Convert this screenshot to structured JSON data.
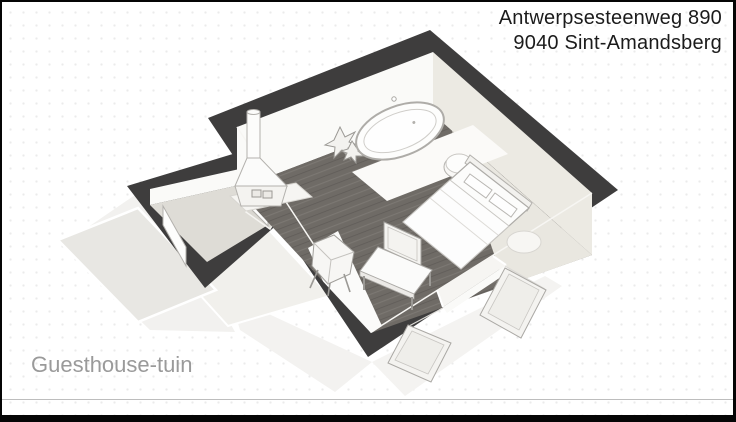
{
  "header": {
    "address_line1": "Antwerpsesteenweg 890",
    "address_line2": "9040 Sint-Amandsberg"
  },
  "caption": {
    "area_label": "Guesthouse-tuin"
  },
  "floorplan": {
    "view": "3d-isometric-floor-plan",
    "rooms": [
      {
        "name": "guesthouse-main-room",
        "floor_materials": [
          "dark-wood-plank",
          "light-carpet"
        ]
      },
      {
        "name": "entry-vestibule",
        "floor_materials": [
          "light-stone"
        ]
      }
    ],
    "furniture": [
      "wood-burning-stove",
      "floor-plant",
      "freestanding-oval-bathtub",
      "bath-mat",
      "round-pouf",
      "double-bed-with-pillows",
      "bedside-round-rug",
      "tv-on-low-bench",
      "lounge-chair",
      "white-floor-rug"
    ],
    "doors": [
      "entry-door-open",
      "interior-door-open",
      "double-french-doors-open"
    ],
    "exterior": [
      "side-terrace",
      "front-path"
    ]
  },
  "colors": {
    "background": "#ffffff",
    "dot_grid": "#ebebeb",
    "frame_border": "#050505",
    "divider": "#bdbdbd",
    "walls": "#3e3d3d",
    "wall_face_light": "#fafaf8",
    "wall_face_shaded": "#eceae3",
    "wood_floor": "#6f6b66",
    "carpet": "#e9e7e0",
    "small_room_floor": "#dedcd6",
    "terrace": "#e8e7e3",
    "terrace_light": "#f1f0ec",
    "furniture_fill": "#fcfcfb",
    "furniture_outline": "#aaa8a4",
    "text_primary": "#1b1b1b",
    "text_muted": "#9a9a9a"
  }
}
